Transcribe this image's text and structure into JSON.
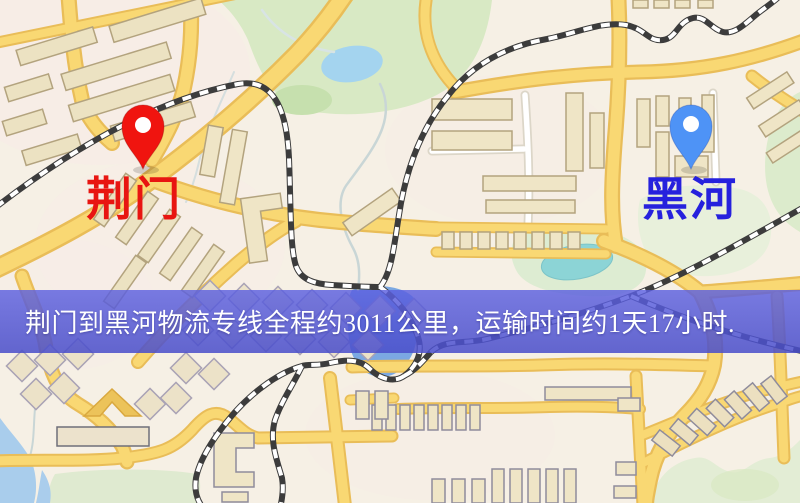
{
  "route_map": {
    "origin": {
      "city": "荆门",
      "pin_icon": "red-location-pin",
      "pin_color": "#f0140f",
      "label_color": "#e81511"
    },
    "destination": {
      "city": "黑河",
      "pin_icon": "blue-location-pin",
      "pin_color": "#4e93f6",
      "label_color": "#2621dd"
    },
    "banner": {
      "text": "荆门到黑河物流专线全程约3011公里，运输时间约1天17小时.",
      "distance_km": "3011",
      "transit_time": "1天17小时",
      "background_color": "#5458d6",
      "text_color": "#ffffff"
    },
    "map_palette": {
      "background": "#f6f0e5",
      "road_primary": "#f9d873",
      "road_casing": "#e9bd58",
      "water_blue": "#a6d6f0",
      "pond_blue": "#7ba8e2",
      "teal_water": "#8cd4d6",
      "park_green": "#d8e9c4",
      "building_fill": "#efe5c6",
      "railway_dark": "#3c3c3c"
    }
  }
}
